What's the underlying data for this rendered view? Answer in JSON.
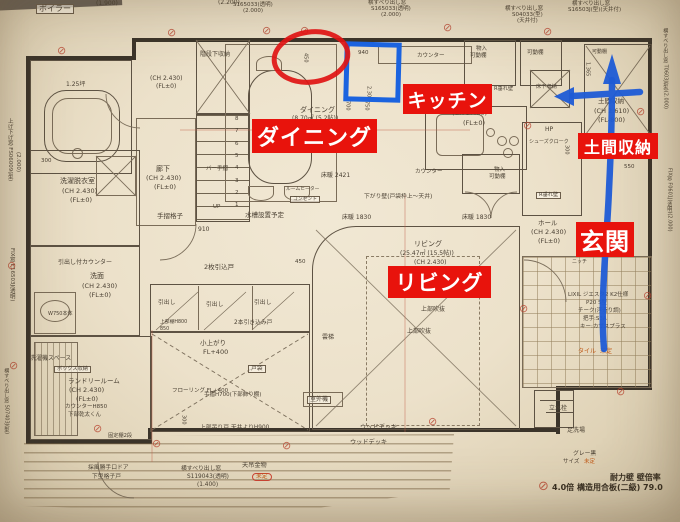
{
  "colors": {
    "annotation_red": "#e8130c",
    "annotation_blue": "#1e5bd6",
    "pencil": "#4a4033",
    "note_orange": "#c05a17"
  },
  "overlay": {
    "labels": [
      {
        "id": "kitchen",
        "text": "キッチン"
      },
      {
        "id": "dining",
        "text": "ダイニング"
      },
      {
        "id": "living",
        "text": "リビング"
      },
      {
        "id": "doma-storage",
        "text": "土間収納"
      },
      {
        "id": "genkan",
        "text": "玄関"
      }
    ],
    "shapes": [
      "red-ellipse",
      "blue-square",
      "blue-arrow-up",
      "blue-arrow-left"
    ]
  },
  "plan": {
    "shear_symbol_glyph": "⊘",
    "stair_numbers": [
      "8",
      "7",
      "6",
      "5",
      "4",
      "3",
      "2",
      "1"
    ],
    "shear_symbols": [
      [
        57,
        45
      ],
      [
        167,
        27
      ],
      [
        262,
        25
      ],
      [
        300,
        25
      ],
      [
        443,
        22
      ],
      [
        543,
        26
      ],
      [
        7,
        260
      ],
      [
        9,
        360
      ],
      [
        93,
        423
      ],
      [
        152,
        438
      ],
      [
        282,
        440
      ],
      [
        428,
        416
      ],
      [
        523,
        120
      ],
      [
        636,
        106
      ],
      [
        643,
        290
      ],
      [
        616,
        386
      ],
      [
        519,
        303
      ],
      [
        538,
        480,
        13
      ]
    ],
    "texts": [
      {
        "t": "ボイラー",
        "x": 36,
        "y": 4,
        "s": 8,
        "bx": true
      },
      {
        "t": "(1.900)",
        "x": 96,
        "y": 1,
        "s": 6
      },
      {
        "t": "(2.200)",
        "x": 218,
        "y": 0,
        "s": 6
      },
      {
        "t": "S165033(透明)",
        "x": 233,
        "y": 3,
        "s": 5.5
      },
      {
        "t": "(2.000)",
        "x": 243,
        "y": 9,
        "s": 5.5
      },
      {
        "t": "横すべり出し窓",
        "x": 368,
        "y": 1,
        "s": 5.5
      },
      {
        "t": "S165033(透明)",
        "x": 371,
        "y": 7,
        "s": 5.5
      },
      {
        "t": "(2.000)",
        "x": 381,
        "y": 13,
        "s": 5.5
      },
      {
        "t": "横すべり出し窓",
        "x": 505,
        "y": 7,
        "s": 5.5
      },
      {
        "t": "S04033(型)",
        "x": 512,
        "y": 13,
        "s": 5.5
      },
      {
        "t": "(天井付)",
        "x": 517,
        "y": 19,
        "s": 5.5
      },
      {
        "t": "横すべり出し窓",
        "x": 572,
        "y": 2,
        "s": 5.5
      },
      {
        "t": "S16503J(型)(天井付)",
        "x": 568,
        "y": 8,
        "s": 5.5
      },
      {
        "t": "上げ下げ窓 FS06009(型)",
        "x": 6,
        "y": 118,
        "s": 5.5,
        "v": true
      },
      {
        "t": "(2.000)",
        "x": 14,
        "y": 152,
        "s": 5.5,
        "v": true
      },
      {
        "t": "FIX窓 F16503J(透明)",
        "x": 8,
        "y": 248,
        "s": 5.5,
        "v": true
      },
      {
        "t": "横すべり出し窓 S07403J(型)",
        "x": 3,
        "y": 368,
        "s": 5,
        "v": true
      },
      {
        "t": "横すべり出し窓 T0603J(型)(2.000)",
        "x": 662,
        "y": 28,
        "s": 5,
        "v": true
      },
      {
        "t": "FIX窓 F0601J(透明)(2.000)",
        "x": 666,
        "y": 168,
        "s": 5,
        "v": true
      },
      {
        "t": "1.25坪",
        "x": 66,
        "y": 82,
        "s": 6
      },
      {
        "t": "階段下収納",
        "x": 200,
        "y": 52,
        "s": 6
      },
      {
        "t": "(CH 2.430)",
        "x": 150,
        "y": 76,
        "s": 6
      },
      {
        "t": "(FL±0)",
        "x": 156,
        "y": 84,
        "s": 6
      },
      {
        "t": "300",
        "x": 41,
        "y": 159,
        "s": 5.5
      },
      {
        "t": "洗濯脱衣室",
        "x": 60,
        "y": 178,
        "s": 7
      },
      {
        "t": "(CH 2.430)",
        "x": 62,
        "y": 188,
        "s": 6.5
      },
      {
        "t": "(FL±0)",
        "x": 70,
        "y": 197,
        "s": 6.5
      },
      {
        "t": "廊下",
        "x": 156,
        "y": 166,
        "s": 7
      },
      {
        "t": "(CH 2.430)",
        "x": 146,
        "y": 175,
        "s": 6.5
      },
      {
        "t": "(FL±0)",
        "x": 154,
        "y": 184,
        "s": 6.5
      },
      {
        "t": "バー手摺",
        "x": 206,
        "y": 167,
        "s": 5.5
      },
      {
        "t": "手摺格子",
        "x": 157,
        "y": 213,
        "s": 6.5
      },
      {
        "t": "910",
        "x": 198,
        "y": 227,
        "s": 6
      },
      {
        "t": "UP",
        "x": 213,
        "y": 205,
        "s": 5.5
      },
      {
        "t": "水槽設置予定",
        "x": 245,
        "y": 212,
        "s": 6.5
      },
      {
        "t": "ルームヒーター",
        "x": 286,
        "y": 187,
        "s": 4.8
      },
      {
        "t": "コンセント",
        "x": 290,
        "y": 196,
        "s": 4.8,
        "bx": true
      },
      {
        "t": "引出し付カウンター",
        "x": 58,
        "y": 260,
        "s": 6
      },
      {
        "t": "洗面",
        "x": 90,
        "y": 273,
        "s": 7
      },
      {
        "t": "(CH 2.430)",
        "x": 82,
        "y": 283,
        "s": 6.5
      },
      {
        "t": "(FL±0)",
        "x": 89,
        "y": 292,
        "s": 6.5
      },
      {
        "t": "W750本体",
        "x": 48,
        "y": 312,
        "s": 5
      },
      {
        "t": "洗濯機スペース",
        "x": 30,
        "y": 356,
        "s": 6
      },
      {
        "t": "ボックス収納",
        "x": 54,
        "y": 366,
        "s": 5.2,
        "bx": true
      },
      {
        "t": "ランドリールーム",
        "x": 68,
        "y": 378,
        "s": 6.5
      },
      {
        "t": "(CH 2.430)",
        "x": 69,
        "y": 387,
        "s": 6.5
      },
      {
        "t": "(FL±0)",
        "x": 76,
        "y": 396,
        "s": 6.5
      },
      {
        "t": "カウンターH850",
        "x": 65,
        "y": 405,
        "s": 5.5
      },
      {
        "t": "下部乾太くん",
        "x": 68,
        "y": 413,
        "s": 5.5
      },
      {
        "t": "固定棚2段",
        "x": 108,
        "y": 434,
        "s": 5.2
      },
      {
        "t": "ダイニング",
        "x": 300,
        "y": 107,
        "s": 7
      },
      {
        "t": "(8.70㎡ (5.2帖))",
        "x": 292,
        "y": 116,
        "s": 6
      },
      {
        "t": "450",
        "x": 302,
        "y": 53,
        "s": 5,
        "v": true
      },
      {
        "t": "940",
        "x": 358,
        "y": 51,
        "s": 5.5
      },
      {
        "t": "2.300",
        "x": 365,
        "y": 86,
        "s": 5,
        "v": true
      },
      {
        "t": "700",
        "x": 344,
        "y": 101,
        "s": 5,
        "v": true
      },
      {
        "t": "750",
        "x": 363,
        "y": 101,
        "s": 5,
        "v": true
      },
      {
        "t": "カウンター",
        "x": 417,
        "y": 54,
        "s": 5.5
      },
      {
        "t": "物入",
        "x": 476,
        "y": 47,
        "s": 5.5
      },
      {
        "t": "可動棚",
        "x": 470,
        "y": 54,
        "s": 5.5
      },
      {
        "t": "可動棚",
        "x": 527,
        "y": 51,
        "s": 5.5
      },
      {
        "t": "可動棚",
        "x": 592,
        "y": 50,
        "s": 5
      },
      {
        "t": "床下収納",
        "x": 536,
        "y": 85,
        "s": 5.2
      },
      {
        "t": "R垂れ壁",
        "x": 494,
        "y": 87,
        "s": 5.2
      },
      {
        "t": "(CH 2.430)",
        "x": 452,
        "y": 110,
        "s": 6.5
      },
      {
        "t": "(FL±0)",
        "x": 463,
        "y": 120,
        "s": 6.5
      },
      {
        "t": "1.365",
        "x": 584,
        "y": 62,
        "s": 5,
        "v": true
      },
      {
        "t": "土間収納",
        "x": 598,
        "y": 98,
        "s": 6.5
      },
      {
        "t": "(CH 2.610)",
        "x": 594,
        "y": 108,
        "s": 6.5
      },
      {
        "t": "(FL-800)",
        "x": 598,
        "y": 117,
        "s": 6.5
      },
      {
        "t": "HP",
        "x": 545,
        "y": 127,
        "s": 6
      },
      {
        "t": "シューズクローク",
        "x": 529,
        "y": 140,
        "s": 5
      },
      {
        "t": "300",
        "x": 563,
        "y": 145,
        "s": 5,
        "v": true
      },
      {
        "t": "床暖 2421",
        "x": 321,
        "y": 173,
        "s": 6
      },
      {
        "t": "カウンター",
        "x": 415,
        "y": 170,
        "s": 5.5
      },
      {
        "t": "物入",
        "x": 494,
        "y": 168,
        "s": 5.5
      },
      {
        "t": "可動棚",
        "x": 489,
        "y": 175,
        "s": 5.5
      },
      {
        "t": "R垂れ壁",
        "x": 536,
        "y": 192,
        "s": 5.2,
        "bx": true
      },
      {
        "t": "550",
        "x": 624,
        "y": 165,
        "s": 5.5
      },
      {
        "t": "下がり壁(戸袋枠上～天井)",
        "x": 364,
        "y": 194,
        "s": 5.8
      },
      {
        "t": "床暖 1830",
        "x": 342,
        "y": 215,
        "s": 6
      },
      {
        "t": "床暖 1830",
        "x": 462,
        "y": 215,
        "s": 6
      },
      {
        "t": "ホール",
        "x": 538,
        "y": 220,
        "s": 6.5
      },
      {
        "t": "(CH 2.430)",
        "x": 531,
        "y": 229,
        "s": 6.5
      },
      {
        "t": "(FL±0)",
        "x": 538,
        "y": 238,
        "s": 6.5
      },
      {
        "t": "ニッチ",
        "x": 572,
        "y": 260,
        "s": 5
      },
      {
        "t": "リビング",
        "x": 414,
        "y": 241,
        "s": 7
      },
      {
        "t": "(25.47㎡ (15.5帖))",
        "x": 400,
        "y": 251,
        "s": 6
      },
      {
        "t": "(CH 2.430)",
        "x": 414,
        "y": 260,
        "s": 6
      },
      {
        "t": "(FL±0)",
        "x": 421,
        "y": 269,
        "s": 6
      },
      {
        "t": "上部吹抜",
        "x": 421,
        "y": 307,
        "s": 6
      },
      {
        "t": "上部吹抜",
        "x": 407,
        "y": 329,
        "s": 6
      },
      {
        "t": "雲梯",
        "x": 322,
        "y": 335,
        "s": 6
      },
      {
        "t": "2枚引込戸",
        "x": 204,
        "y": 264,
        "s": 6.5
      },
      {
        "t": "450",
        "x": 295,
        "y": 260,
        "s": 5.5
      },
      {
        "t": "引出し",
        "x": 158,
        "y": 300,
        "s": 5.8
      },
      {
        "t": "引出し",
        "x": 206,
        "y": 302,
        "s": 5.8
      },
      {
        "t": "引出し",
        "x": 254,
        "y": 300,
        "s": 5.8
      },
      {
        "t": "上部棚H800",
        "x": 160,
        "y": 320,
        "s": 4.8
      },
      {
        "t": "850",
        "x": 160,
        "y": 327,
        "s": 4.8
      },
      {
        "t": "2本引き込み戸",
        "x": 234,
        "y": 320,
        "s": 5.8
      },
      {
        "t": "小上がり",
        "x": 200,
        "y": 340,
        "s": 6.5
      },
      {
        "t": "FL+400",
        "x": 203,
        "y": 349,
        "s": 6.5
      },
      {
        "t": "戸袋",
        "x": 248,
        "y": 365,
        "s": 5.8,
        "bx": true
      },
      {
        "t": "フローリング FL+400",
        "x": 172,
        "y": 389,
        "s": 5.5
      },
      {
        "t": "手摺H700(下部飾り棚)",
        "x": 204,
        "y": 393,
        "s": 5.5
      },
      {
        "t": "300",
        "x": 180,
        "y": 415,
        "s": 5,
        "v": true
      },
      {
        "t": "上部吊り戸 天井よりH900",
        "x": 200,
        "y": 425,
        "s": 5.8
      },
      {
        "t": "室外機",
        "x": 307,
        "y": 396,
        "s": 6,
        "bx": true
      },
      {
        "t": "ウッドデッキ",
        "x": 360,
        "y": 425,
        "s": 6.2
      },
      {
        "t": "ウッドデッキ",
        "x": 350,
        "y": 440,
        "s": 6.2
      },
      {
        "t": "採風勝手口ドア",
        "x": 88,
        "y": 465,
        "s": 5.8
      },
      {
        "t": "下型格子戸",
        "x": 92,
        "y": 474,
        "s": 5.8
      },
      {
        "t": "横すべり出し窓",
        "x": 181,
        "y": 466,
        "s": 5.8
      },
      {
        "t": "S119043(透明)",
        "x": 187,
        "y": 474,
        "s": 5.8
      },
      {
        "t": "(1.400)",
        "x": 197,
        "y": 482,
        "s": 5.8
      },
      {
        "t": "天吊金物",
        "x": 242,
        "y": 463,
        "s": 6.2
      },
      {
        "t": "未定",
        "x": 252,
        "y": 473,
        "s": 5.8,
        "c": "o",
        "rb": true
      },
      {
        "t": "LIXIL ジエスタ2 K2仕様",
        "x": 568,
        "y": 293,
        "s": 5.5
      },
      {
        "t": "P20 S型",
        "x": 586,
        "y": 301,
        "s": 5.5
      },
      {
        "t": "チーク(浮造り調)",
        "x": 578,
        "y": 309,
        "s": 5.5
      },
      {
        "t": "把手:S3A",
        "x": 583,
        "y": 317,
        "s": 5.5
      },
      {
        "t": "キー:カザスプラス",
        "x": 580,
        "y": 325,
        "s": 5.5
      },
      {
        "t": "タイル",
        "x": 578,
        "y": 349,
        "s": 6,
        "c": "o"
      },
      {
        "t": "未定",
        "x": 600,
        "y": 349,
        "s": 6,
        "c": "o"
      },
      {
        "t": "立水栓",
        "x": 549,
        "y": 406,
        "s": 6
      },
      {
        "t": "足洗場",
        "x": 567,
        "y": 428,
        "s": 6
      },
      {
        "t": "グレー黒",
        "x": 573,
        "y": 451,
        "s": 5.8
      },
      {
        "t": "サイズ",
        "x": 563,
        "y": 460,
        "s": 5.5
      },
      {
        "t": "未定",
        "x": 584,
        "y": 460,
        "s": 5.5,
        "c": "o"
      },
      {
        "t": "耐力壁  壁倍率",
        "x": 610,
        "y": 474,
        "s": 8,
        "b": true
      },
      {
        "t": "4.0倍  構造用合板(二級)  79.0",
        "x": 552,
        "y": 484,
        "s": 8,
        "b": true
      }
    ]
  }
}
